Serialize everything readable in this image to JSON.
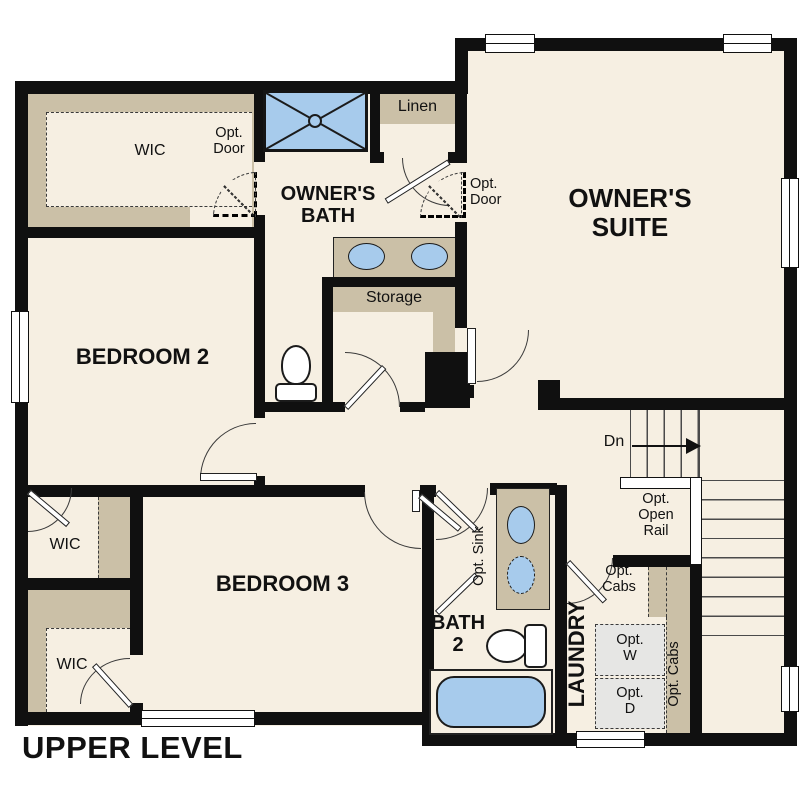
{
  "title": "UPPER LEVEL",
  "colors": {
    "floor": "#f6efe2",
    "wall": "#101010",
    "cabinet_tan": "#cbc0a7",
    "fixture_blue": "#a7cbec",
    "appliance_gray": "#e6e6e4"
  },
  "rooms": {
    "owners_suite": {
      "lines": [
        "OWNER'S",
        "SUITE"
      ]
    },
    "owners_bath": {
      "lines": [
        "OWNER'S",
        "BATH"
      ]
    },
    "bedroom2": {
      "label": "BEDROOM 2"
    },
    "bedroom3": {
      "label": "BEDROOM 3"
    },
    "bath2": {
      "lines": [
        "BATH",
        "2"
      ]
    },
    "laundry": {
      "label": "LAUNDRY"
    },
    "wic_top": {
      "label": "WIC"
    },
    "wic_mid": {
      "label": "WIC"
    },
    "wic_bottom": {
      "label": "WIC"
    },
    "linen": {
      "label": "Linen"
    },
    "storage": {
      "label": "Storage"
    }
  },
  "annotations": {
    "opt_door_wic": {
      "lines": [
        "Opt.",
        "Door"
      ]
    },
    "opt_door_suite": {
      "lines": [
        "Opt.",
        "Door"
      ]
    },
    "opt_open_rail": {
      "lines": [
        "Opt.",
        "Open",
        "Rail"
      ]
    },
    "opt_sink": {
      "label": "Opt. Sink"
    },
    "opt_cabs_laundry": {
      "lines": [
        "Opt.",
        "Cabs"
      ]
    },
    "opt_cabs_vertical": {
      "label": "Opt. Cabs"
    },
    "opt_washer": {
      "lines": [
        "Opt.",
        "W"
      ]
    },
    "opt_dryer": {
      "lines": [
        "Opt.",
        "D"
      ]
    },
    "stairs_down": {
      "label": "Dn"
    }
  }
}
